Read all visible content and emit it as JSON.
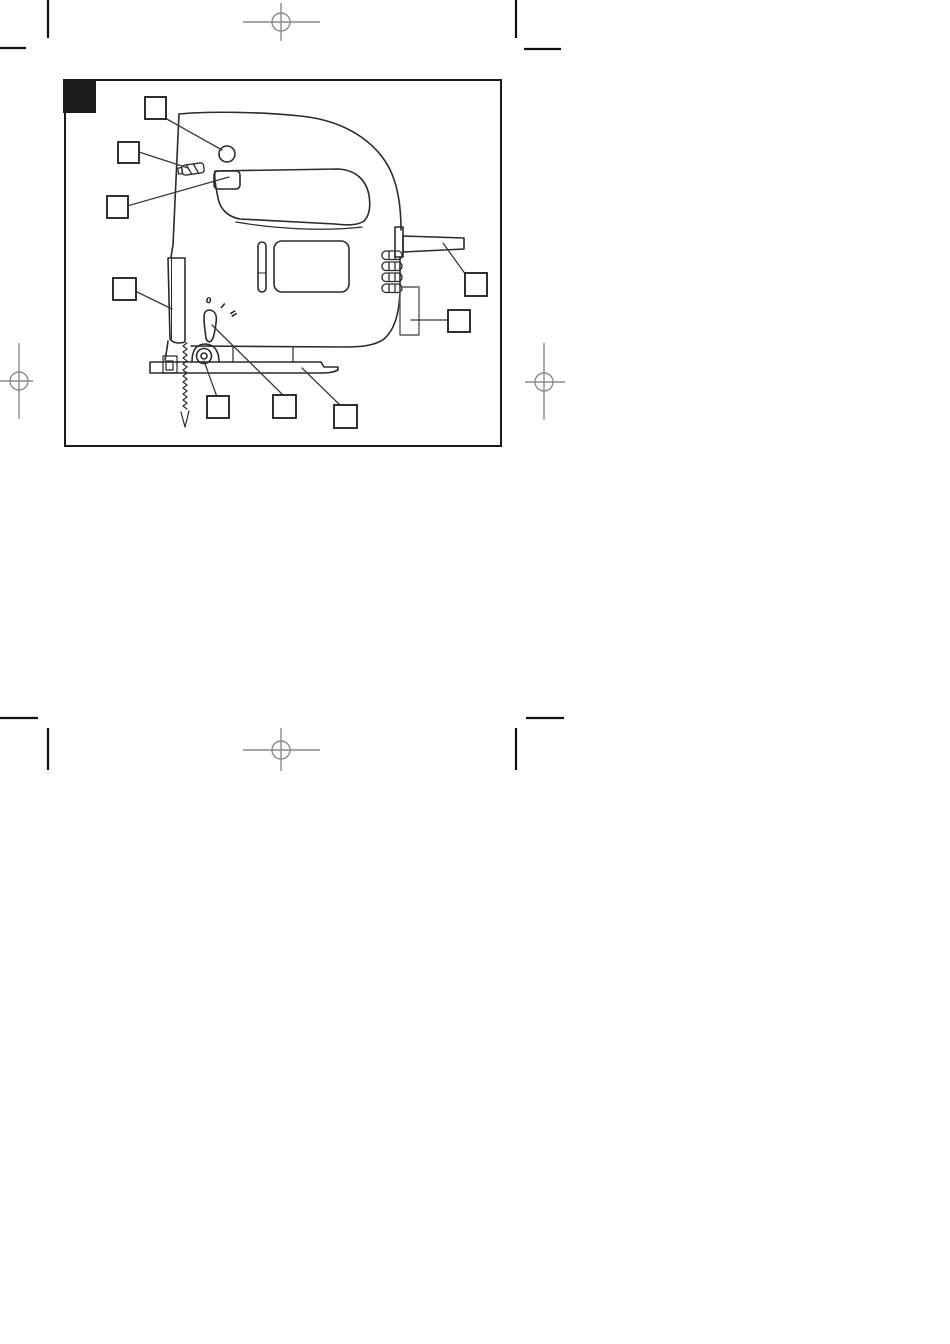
{
  "document": {
    "kind": "scanned-manual-figure-page",
    "figure": {
      "subject": "jigsaw power tool side-view line drawing with empty callout boxes",
      "callout_box_count": 9,
      "switch_markings": [
        "0",
        "I",
        "II"
      ]
    },
    "colors": {
      "paper": "#ffffff",
      "ink": "#2b2b2b",
      "border": "#1a1a1a",
      "marker_fill": "#1c1c1c",
      "registration_gray": "#8a8a8a",
      "tick_black": "#111111",
      "leader": "#3a3a3a",
      "port_gray": "#5a5a5a"
    }
  }
}
